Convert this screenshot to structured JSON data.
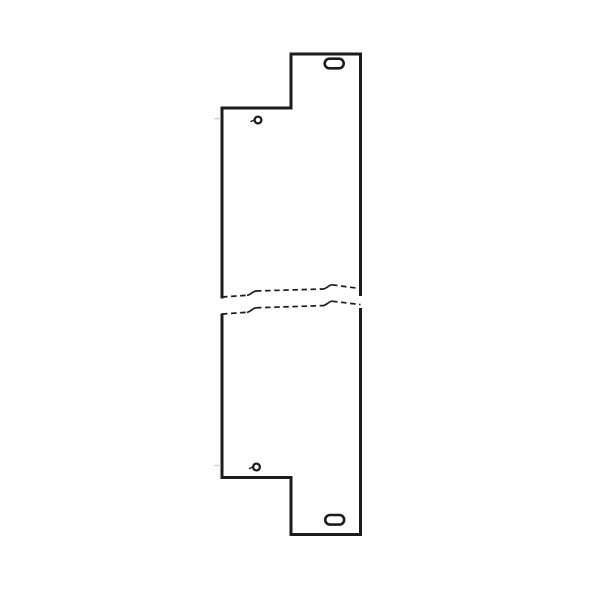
{
  "page": {
    "width": 600,
    "height": 600,
    "background": "#ffffff"
  },
  "drawing": {
    "kind": "technical-line-drawing",
    "subject": "notched blank panel front view with break lines",
    "ink": "#1c1c1e",
    "faint": "#a9b4c4",
    "dash_pattern": "5.5 3.6",
    "break_stroke_width": 1.7,
    "slots_stroke_width": 2.6,
    "holes_stroke_width": 2.3,
    "tick_stroke_width": 1.4,
    "faint_stroke_width": 1.2,
    "outline": {
      "stroke_width": 3,
      "segments": [
        {
          "name": "panel-outline-upper",
          "d": "M222 298.5 L222 108 L291 108 L291 54 L360.5 54 L360.5 296"
        },
        {
          "name": "panel-outline-lower",
          "d": "M222 313.5 L222 477.5 L291 477.5 L291 534.5 L360.5 534.5 L360.5 308"
        }
      ]
    },
    "slots": [
      {
        "name": "mounting-slot-top",
        "cx": 334.2,
        "cy": 63.5,
        "w": 19,
        "h": 9.6
      },
      {
        "name": "mounting-slot-bottom",
        "cx": 334.7,
        "cy": 519.8,
        "w": 19,
        "h": 9.6
      }
    ],
    "holes": [
      {
        "name": "pilot-hole-top",
        "cx": 258,
        "cy": 120,
        "r": 3.4,
        "tick": "M251 121.5 L254.6 119.7"
      },
      {
        "name": "pilot-hole-bottom",
        "cx": 256.5,
        "cy": 467,
        "r": 3.4,
        "tick": "M249.5 468.5 L253.1 466.7"
      }
    ],
    "break_lines": [
      {
        "name": "break-line-upper",
        "dashed": [
          "M222 297 L247 295.3",
          "M256 291 L323 289",
          "M332 284.8 L360.5 288.6"
        ],
        "solid": [
          "M247 295.3 C250 295.2 253 291.1 256 291",
          "M323 289 C326 288.9 329 284.9 332 284.8"
        ]
      },
      {
        "name": "break-line-lower",
        "dashed": [
          "M222 314 L247 312.3",
          "M256 307.8 L323 305.6",
          "M332 301.2 L360.5 304.6"
        ],
        "solid": [
          "M247 312.3 C250 312.2 253 307.9 256 307.8",
          "M323 305.6 C326 305.5 329 301.3 332 301.2"
        ]
      }
    ],
    "faint_ticks": [
      {
        "name": "centerline-tick-top",
        "d": "M214.5 118.6 L221.2 118.6"
      },
      {
        "name": "centerline-tick-bottom",
        "d": "M214.5 465.5 L221.2 465.5"
      }
    ]
  }
}
